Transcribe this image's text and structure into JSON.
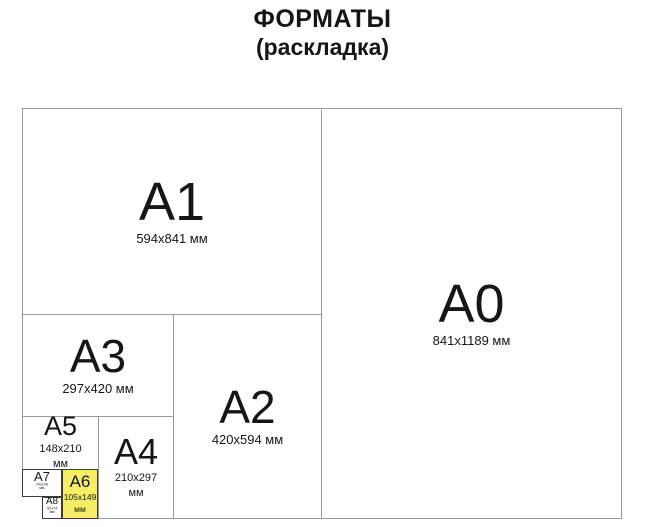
{
  "title": {
    "line1": "ФОРМАТЫ",
    "line2": "(раскладка)"
  },
  "colors": {
    "highlight_yellow": "#f5ee66",
    "line_gray": "#9a9a9a",
    "line_dark": "#3b3b3b",
    "text_black": "#161616"
  },
  "formats": {
    "a0": {
      "label": "A0",
      "size_lines": [
        "841x1189 мм"
      ]
    },
    "a1": {
      "label": "A1",
      "size_lines": [
        "594x841 мм"
      ]
    },
    "a2": {
      "label": "A2",
      "size_lines": [
        "420x594 мм"
      ]
    },
    "a3": {
      "label": "A3",
      "size_lines": [
        "297x420 мм"
      ]
    },
    "a4": {
      "label": "A4",
      "size_lines": [
        "210x297",
        "мм"
      ]
    },
    "a5": {
      "label": "A5",
      "size_lines": [
        "148x210",
        "мм"
      ]
    },
    "a6": {
      "label": "A6",
      "size_lines": [
        "105x149",
        "мм"
      ],
      "highlighted": true
    },
    "a7": {
      "label": "A7",
      "size_lines": [
        "74x105",
        "мм"
      ]
    },
    "a8": {
      "label": "A8",
      "size_lines": [
        "52x74",
        "мм"
      ]
    }
  }
}
